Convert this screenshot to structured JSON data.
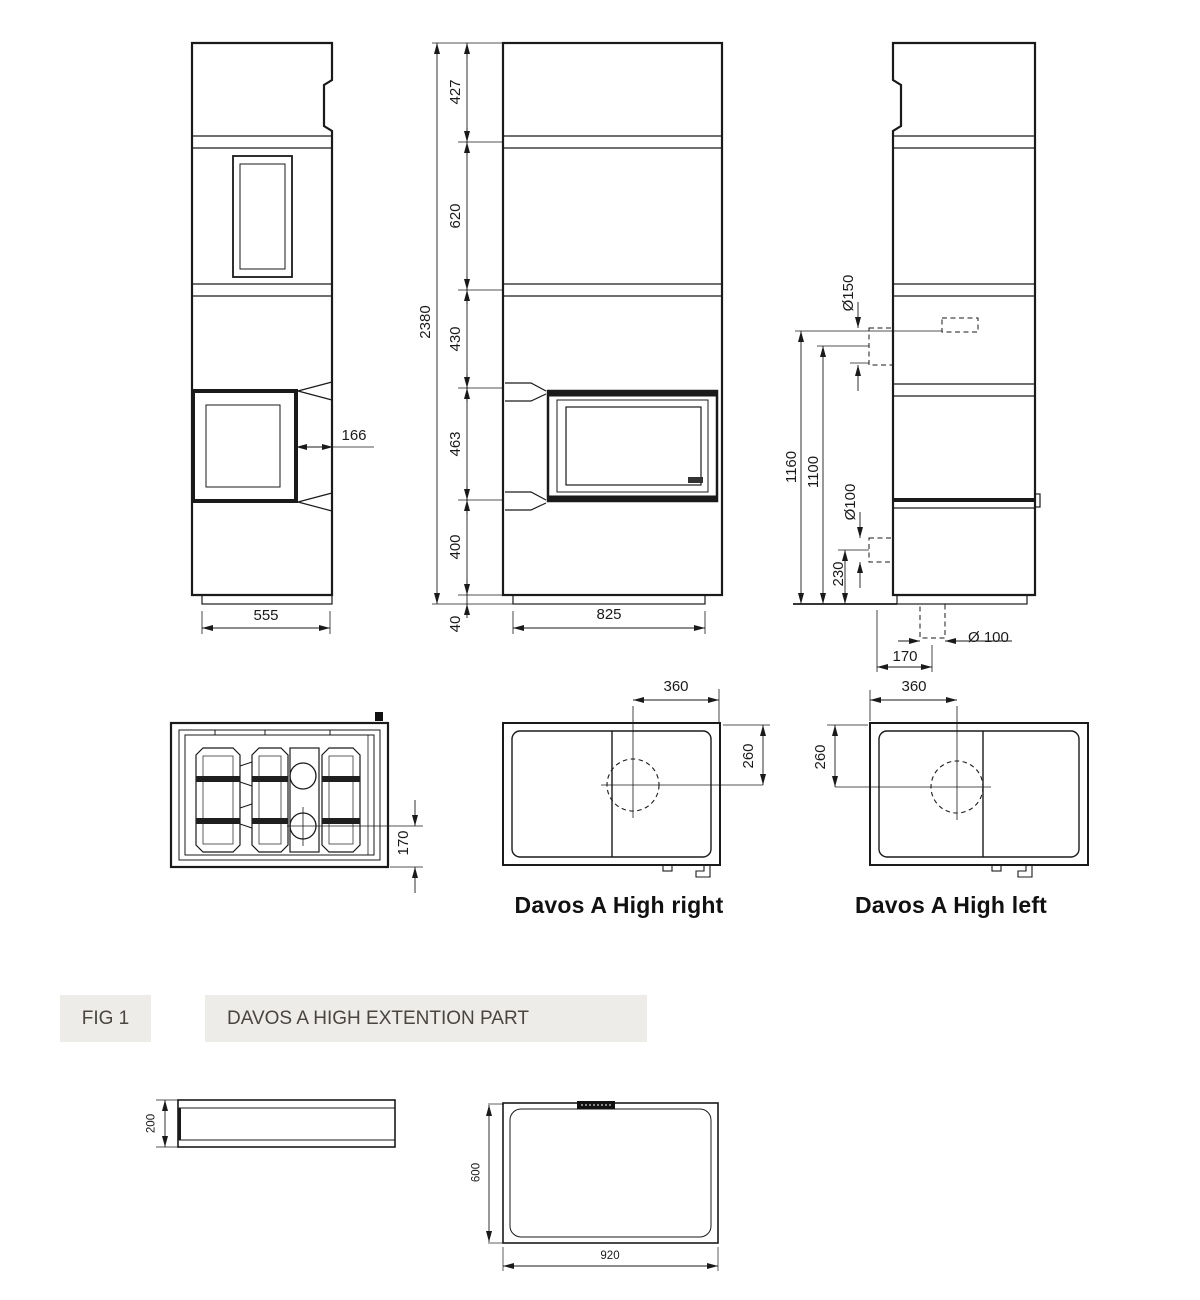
{
  "figure": {
    "label": "FIG 1",
    "title": "DAVOS A HIGH EXTENTION PART"
  },
  "side_view_left": {
    "width": "555",
    "firebox_depth": "166"
  },
  "front_view": {
    "total_height": "2380",
    "height_segments": [
      "427",
      "620",
      "430",
      "463",
      "400",
      "40"
    ],
    "width": "825"
  },
  "side_view_right": {
    "top_flue_diameter": "Ø150",
    "top_flue_height": "1160",
    "top_flue_center_height": "1100",
    "rear_flue_diameter": "Ø100",
    "rear_flue_height": "230",
    "floor_flue_diameter": "Ø 100",
    "floor_flue_offset": "170"
  },
  "top_view_detail": {
    "flue_offset": "170"
  },
  "top_view_right_model": {
    "title": "Davos A High right",
    "flue_offset_x": "360",
    "flue_offset_y": "260"
  },
  "top_view_left_model": {
    "title": "Davos A High left",
    "flue_offset_x": "360",
    "flue_offset_y": "260"
  },
  "extension_part": {
    "side_height": "200",
    "top_depth": "600",
    "top_width": "920"
  },
  "colors": {
    "line": "#1a1a1a",
    "fig_box_bg": "#edece9",
    "fig_box_text": "#4a4540"
  }
}
